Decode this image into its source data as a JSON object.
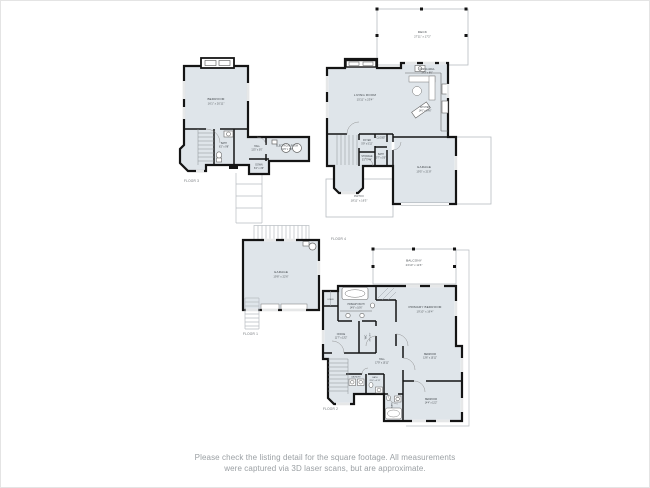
{
  "caption": {
    "line1": "Please check the listing detail for the square footage. All measurements",
    "line2": "were captured via 3D laser scans, but are approximate."
  },
  "colors": {
    "room_fill": "#dfe5ea",
    "wall": "#141414",
    "thin_outline": "#b7bcc1",
    "label_text": "#41464b",
    "caption_text": "#9ba0a4"
  },
  "floor3": {
    "label": "FLOOR 3",
    "rooms": {
      "bedroom": {
        "name": "BEDROOM",
        "dims": "16'1\" x 20'11\""
      },
      "bath": {
        "name": "BATH",
        "dims": "6'2\" x 9'8\""
      },
      "hall": {
        "name": "HALL",
        "dims": "11'5\" x 3'0\""
      },
      "electrical_room": {
        "name": "ELECTRICAL ROOM",
        "dims": "12'9\" x 7'6\""
      },
      "down": {
        "name": "DOWN",
        "dims": "6'4\" x 4'6\""
      }
    }
  },
  "floor4": {
    "label": "FLOOR 4",
    "rooms": {
      "deck": {
        "name": "DECK",
        "dims": "27'11\" x 17'2\""
      },
      "dining_area": {
        "name": "DINING AREA",
        "dims": "14'3\" x 8'6\""
      },
      "living_room": {
        "name": "LIVING ROOM",
        "dims": "15'11\" x 23'4\""
      },
      "kitchen": {
        "name": "KITCHEN",
        "dims": "14'0\" x 14'6\""
      },
      "foyer": {
        "name": "FOYER",
        "dims": "5'9\" x 5'11\""
      },
      "closet": {
        "name": "CLOSET",
        "dims": "3'0\" x 4'2\""
      },
      "bath": {
        "name": "BATH",
        "dims": "5'7\" x 5'0\""
      },
      "storage": {
        "name": "STORAGE",
        "dims": "5'2\" x 4'4\""
      },
      "garage": {
        "name": "GARAGE",
        "dims": "19'5\" x 21'8\""
      },
      "patio": {
        "name": "PATIO",
        "dims": "18'11\" x 16'3\""
      }
    }
  },
  "floor1": {
    "label": "FLOOR 1",
    "rooms": {
      "garage": {
        "name": "GARAGE",
        "dims": "19'8\" x 22'6\""
      }
    }
  },
  "floor2": {
    "label": "FLOOR 2",
    "rooms": {
      "balcony": {
        "name": "BALCONY",
        "dims": "23'10\" x 11'6\""
      },
      "primary_bath": {
        "name": "PRIMARY BATH",
        "dims": "14'9\" x 10'6\""
      },
      "primary_bedroom": {
        "name": "PRIMARY BEDROOM",
        "dims": "19'10\" x 16'4\""
      },
      "linen": {
        "name": "LINEN"
      },
      "office": {
        "name": "OFFICE",
        "dims": "11'7\" x 13'2\""
      },
      "wic": {
        "name": "WIC",
        "dims": "4'6\" x 9'9\""
      },
      "hall": {
        "name": "HALL",
        "dims": "17'9\" x 10'11\""
      },
      "bedroom2": {
        "name": "BEDROOM",
        "dims": "13'6\" x 10'11\""
      },
      "laundry": {
        "name": "LAUNDRY",
        "dims": "5'5\" x 3'1\""
      },
      "bath": {
        "name": "BATH",
        "dims": "8'10\" x 4'11\""
      },
      "bath2": {
        "name": "BATH"
      },
      "bedroom3": {
        "name": "BEDROOM",
        "dims": "14'4\" x 11'2\""
      }
    }
  }
}
